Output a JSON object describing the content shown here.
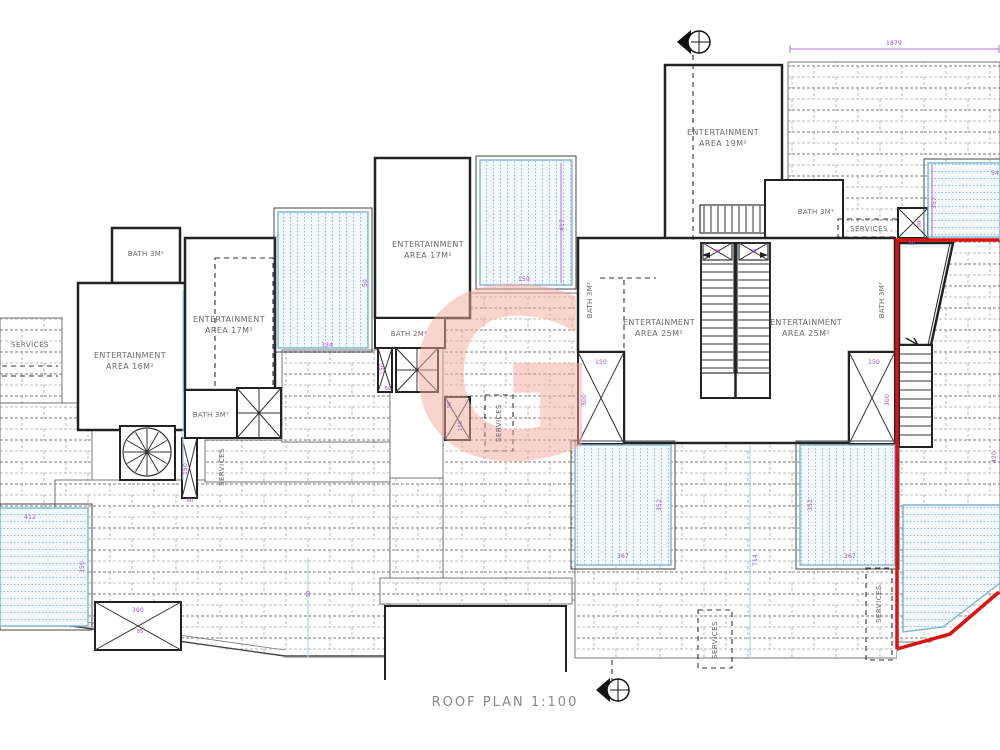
{
  "title": {
    "text": "ROOF PLAN 1:100"
  },
  "watermark": {
    "letter": "G"
  },
  "colors": {
    "wall": "#222222",
    "tile_line": "#a8a8a8",
    "pool_line": "#7fb2d4",
    "pool_fill": "#f2f8fc",
    "dimension": "#a24fc9",
    "boundary_red": "#dd1111",
    "watermark_pink": "#f3ab9b"
  },
  "rooms": [
    {
      "name": "entertainment-area-16",
      "line1": "ENTERTAINMENT",
      "line2": "AREA 16M²"
    },
    {
      "name": "entertainment-area-17-left",
      "line1": "ENTERTAINMENT",
      "line2": "AREA 17M²"
    },
    {
      "name": "entertainment-area-17-middle",
      "line1": "ENTERTAINMENT",
      "line2": "AREA 17M²"
    },
    {
      "name": "entertainment-area-19",
      "line1": "ENTERTAINMENT",
      "line2": "AREA 19M²"
    },
    {
      "name": "entertainment-area-25-left",
      "line1": "ENTERTAINMENT",
      "line2": "AREA 25M²"
    },
    {
      "name": "entertainment-area-25-right",
      "line1": "ENTERTAINMENT",
      "line2": "AREA 25M²"
    }
  ],
  "baths": [
    {
      "name": "bath-top-left",
      "text": "BATH 3M²"
    },
    {
      "name": "bath-left-lower",
      "text": "BATH 3M²"
    },
    {
      "name": "bath-middle",
      "text": "BATH 2M²"
    },
    {
      "name": "bath-top-right",
      "text": "BATH 3M²"
    },
    {
      "name": "bath-25-left",
      "text": "BATH 3M²"
    },
    {
      "name": "bath-25-right",
      "text": "BATH 3M²"
    }
  ],
  "services": [
    {
      "name": "services-left",
      "text": "SERVICES"
    },
    {
      "name": "services-left-vertical",
      "text": "SERVICES"
    },
    {
      "name": "services-middle",
      "text": "SERVICES"
    },
    {
      "name": "services-top-right",
      "text": "SERVICES"
    },
    {
      "name": "services-bottom",
      "text": "SERVICES"
    },
    {
      "name": "services-right",
      "text": "SERVICES"
    }
  ],
  "dims": [
    {
      "name": "dim-top-width",
      "text": "1879"
    },
    {
      "name": "dim-pool-mid-height",
      "text": "417"
    },
    {
      "name": "dim-pool-mid-width",
      "text": "159"
    },
    {
      "name": "dim-pool-left-width",
      "text": "334"
    },
    {
      "name": "dim-pool-left-height",
      "text": "50"
    },
    {
      "name": "dim-pool-bl-width",
      "text": "412"
    },
    {
      "name": "dim-pool-bl-height",
      "text": "350"
    },
    {
      "name": "dim-box-bl-width",
      "text": "360"
    },
    {
      "name": "dim-box-bl-height",
      "text": "85"
    },
    {
      "name": "dim-shaft-left-height",
      "text": "150"
    },
    {
      "name": "dim-shaft-left-width",
      "text": "60"
    },
    {
      "name": "dim-shaft-mid-height",
      "text": "150"
    },
    {
      "name": "dim-shaft-mid-width",
      "text": "60"
    },
    {
      "name": "dim-box-mid-a",
      "text": "90"
    },
    {
      "name": "dim-box-mid-b",
      "text": "150"
    },
    {
      "name": "dim-skylight-left-width",
      "text": "150"
    },
    {
      "name": "dim-skylight-left-height",
      "text": "300"
    },
    {
      "name": "dim-skylight-right-width",
      "text": "150"
    },
    {
      "name": "dim-skylight-right-height",
      "text": "300"
    },
    {
      "name": "dim-stairbox-left",
      "text": "90"
    },
    {
      "name": "dim-stairbox-right",
      "text": "90"
    },
    {
      "name": "dim-pool-tr-height",
      "text": "357"
    },
    {
      "name": "dim-pool-tr-width",
      "text": "54"
    },
    {
      "name": "dim-box-tr-width",
      "text": "60"
    },
    {
      "name": "dim-box-tr-height",
      "text": "90"
    },
    {
      "name": "dim-pool-b1-height",
      "text": "352"
    },
    {
      "name": "dim-pool-b1-width",
      "text": "367"
    },
    {
      "name": "dim-pool-b2-height",
      "text": "352"
    },
    {
      "name": "dim-pool-b2-width",
      "text": "367"
    },
    {
      "name": "dim-deck-height",
      "text": "714"
    },
    {
      "name": "dim-pool-right-height",
      "text": "420"
    },
    {
      "name": "dim-deck-line",
      "text": "30"
    }
  ]
}
